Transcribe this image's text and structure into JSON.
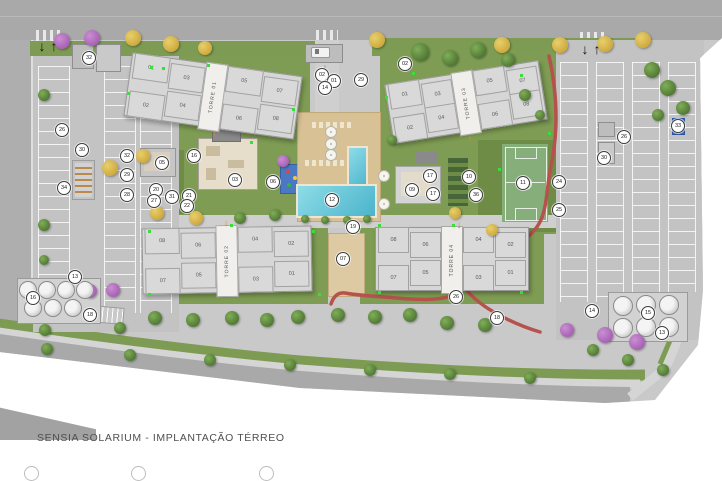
{
  "title": {
    "text": "SENSIA SOLARIUM - IMPLANTAÇÃO TÉRREO"
  },
  "towers": [
    {
      "name": "TORRE 01",
      "x": 127,
      "y": 64,
      "w": 170,
      "h": 62,
      "rot": 8,
      "top": [
        "01",
        "03",
        "05",
        "07"
      ],
      "bottom": [
        "02",
        "04",
        "06",
        "08"
      ]
    },
    {
      "name": "TORRE 03",
      "x": 388,
      "y": 72,
      "w": 154,
      "h": 58,
      "rot": -9,
      "top": [
        "01",
        "03",
        "05",
        "07"
      ],
      "bottom": [
        "02",
        "04",
        "06",
        "08"
      ]
    },
    {
      "name": "TORRE 02",
      "x": 142,
      "y": 227,
      "w": 168,
      "h": 64,
      "rot": -1,
      "top": [
        "08",
        "06",
        "04",
        "02"
      ],
      "bottom": [
        "07",
        "05",
        "03",
        "01"
      ]
    },
    {
      "name": "TORRE 04",
      "x": 375,
      "y": 227,
      "w": 152,
      "h": 62,
      "rot": 0,
      "top": [
        "08",
        "06",
        "04",
        "02"
      ],
      "bottom": [
        "07",
        "05",
        "03",
        "01"
      ]
    }
  ],
  "markers": [
    [
      "02",
      322,
      75
    ],
    [
      "01",
      334,
      81
    ],
    [
      "14",
      325,
      88
    ],
    [
      "29",
      361,
      80
    ],
    [
      "02",
      405,
      64
    ],
    [
      "32",
      89,
      58
    ],
    [
      "26",
      62,
      130
    ],
    [
      "30",
      82,
      150
    ],
    [
      "34",
      64,
      188
    ],
    [
      "13",
      75,
      277
    ],
    [
      "16",
      33,
      298
    ],
    [
      "18",
      90,
      315
    ],
    [
      "32",
      127,
      156
    ],
    [
      "29",
      127,
      175
    ],
    [
      "28",
      127,
      195
    ],
    [
      "05",
      162,
      163
    ],
    [
      "16",
      194,
      156
    ],
    [
      "03",
      235,
      180
    ],
    [
      "06",
      273,
      182
    ],
    [
      "20",
      156,
      190
    ],
    [
      "31",
      172,
      197
    ],
    [
      "21",
      189,
      196
    ],
    [
      "27",
      154,
      201
    ],
    [
      "22",
      187,
      206
    ],
    [
      "12",
      332,
      200
    ],
    [
      "19",
      353,
      227
    ],
    [
      "07",
      343,
      259
    ],
    [
      "09",
      412,
      190
    ],
    [
      "17",
      430,
      176
    ],
    [
      "17",
      433,
      194
    ],
    [
      "10",
      469,
      177
    ],
    [
      "36",
      476,
      195
    ],
    [
      "11",
      523,
      183
    ],
    [
      "24",
      559,
      182
    ],
    [
      "25",
      559,
      210
    ],
    [
      "26",
      624,
      137
    ],
    [
      "30",
      604,
      158
    ],
    [
      "33",
      678,
      126
    ],
    [
      "26",
      456,
      297
    ],
    [
      "18",
      497,
      318
    ],
    [
      "14",
      592,
      311
    ],
    [
      "15",
      648,
      313
    ],
    [
      "13",
      662,
      333
    ]
  ],
  "trees": [
    [
      133,
      38,
      8,
      "y"
    ],
    [
      171,
      44,
      8,
      "y"
    ],
    [
      205,
      48,
      7,
      "y"
    ],
    [
      377,
      40,
      8,
      "y"
    ],
    [
      502,
      45,
      8,
      "y"
    ],
    [
      560,
      45,
      8,
      "y"
    ],
    [
      605,
      44,
      8,
      "y"
    ],
    [
      643,
      40,
      8,
      "y"
    ],
    [
      62,
      41,
      8,
      "p"
    ],
    [
      92,
      38,
      8,
      "p"
    ],
    [
      420,
      52,
      9,
      "g"
    ],
    [
      450,
      58,
      8,
      "g"
    ],
    [
      478,
      50,
      8,
      "g"
    ],
    [
      508,
      60,
      7,
      "g"
    ],
    [
      652,
      70,
      8,
      "g"
    ],
    [
      668,
      88,
      8,
      "g"
    ],
    [
      683,
      108,
      7,
      "g"
    ],
    [
      658,
      115,
      6,
      "g"
    ],
    [
      143,
      156,
      7,
      "y"
    ],
    [
      110,
      168,
      8,
      "y"
    ],
    [
      157,
      213,
      7,
      "y"
    ],
    [
      196,
      218,
      7,
      "y"
    ],
    [
      240,
      218,
      6,
      "g"
    ],
    [
      275,
      215,
      6,
      "g"
    ],
    [
      455,
      213,
      6,
      "y"
    ],
    [
      492,
      230,
      6,
      "y"
    ],
    [
      283,
      161,
      6,
      "p"
    ],
    [
      44,
      95,
      6,
      "g"
    ],
    [
      44,
      225,
      6,
      "g"
    ],
    [
      44,
      260,
      5,
      "g"
    ],
    [
      90,
      291,
      7,
      "p"
    ],
    [
      113,
      290,
      7,
      "p"
    ],
    [
      567,
      330,
      7,
      "p"
    ],
    [
      605,
      335,
      8,
      "p"
    ],
    [
      637,
      342,
      8,
      "p"
    ],
    [
      45,
      330,
      6,
      "g"
    ],
    [
      120,
      328,
      6,
      "g"
    ],
    [
      155,
      318,
      7,
      "g"
    ],
    [
      193,
      320,
      7,
      "g"
    ],
    [
      232,
      318,
      7,
      "g"
    ],
    [
      267,
      320,
      7,
      "g"
    ],
    [
      298,
      317,
      7,
      "g"
    ],
    [
      338,
      315,
      7,
      "g"
    ],
    [
      375,
      317,
      7,
      "g"
    ],
    [
      410,
      315,
      7,
      "g"
    ],
    [
      447,
      323,
      7,
      "g"
    ],
    [
      485,
      325,
      7,
      "g"
    ],
    [
      47,
      349,
      6,
      "g"
    ],
    [
      130,
      355,
      6,
      "g"
    ],
    [
      210,
      360,
      6,
      "g"
    ],
    [
      290,
      365,
      6,
      "g"
    ],
    [
      370,
      370,
      6,
      "g"
    ],
    [
      450,
      374,
      6,
      "g"
    ],
    [
      530,
      378,
      6,
      "g"
    ],
    [
      593,
      350,
      6,
      "g"
    ],
    [
      628,
      360,
      6,
      "g"
    ],
    [
      663,
      370,
      6,
      "g"
    ],
    [
      525,
      95,
      6,
      "g"
    ],
    [
      540,
      115,
      5,
      "g"
    ],
    [
      392,
      140,
      5,
      "g"
    ],
    [
      305,
      219,
      4,
      "g"
    ],
    [
      325,
      220,
      4,
      "g"
    ],
    [
      347,
      220,
      4,
      "g"
    ],
    [
      367,
      219,
      4,
      "g"
    ]
  ],
  "green_dots": [
    [
      127,
      92
    ],
    [
      150,
      66
    ],
    [
      207,
      64
    ],
    [
      292,
      108
    ],
    [
      250,
      141
    ],
    [
      162,
      67
    ],
    [
      385,
      96
    ],
    [
      412,
      72
    ],
    [
      520,
      74
    ],
    [
      548,
      132
    ],
    [
      498,
      168
    ],
    [
      148,
      230
    ],
    [
      148,
      293
    ],
    [
      230,
      224
    ],
    [
      312,
      230
    ],
    [
      318,
      293
    ],
    [
      378,
      224
    ],
    [
      378,
      291
    ],
    [
      452,
      224
    ],
    [
      520,
      291
    ]
  ],
  "umbrellas": [
    [
      330,
      131
    ],
    [
      330,
      143
    ],
    [
      330,
      154
    ],
    [
      383,
      175
    ],
    [
      383,
      203
    ]
  ],
  "tanks_left": [
    [
      27,
      289
    ],
    [
      46,
      289
    ],
    [
      65,
      289
    ],
    [
      84,
      289
    ],
    [
      32,
      307
    ],
    [
      52,
      307
    ],
    [
      72,
      307
    ]
  ],
  "tanks_right": [
    [
      622,
      305
    ],
    [
      645,
      304
    ],
    [
      668,
      304
    ],
    [
      622,
      327
    ],
    [
      645,
      326
    ],
    [
      668,
      326
    ]
  ],
  "arrows": [
    {
      "x": 42,
      "y": 46,
      "g": "↓",
      "c": "#111111",
      "s": 14
    },
    {
      "x": 54,
      "y": 46,
      "g": "↑",
      "c": "#111111",
      "s": 14
    },
    {
      "x": 585,
      "y": 49,
      "g": "↓",
      "c": "#111111",
      "s": 14
    },
    {
      "x": 597,
      "y": 49,
      "g": "↑",
      "c": "#111111",
      "s": 14
    },
    {
      "x": 325,
      "y": 68,
      "g": "↓",
      "c": "#2f7fd6",
      "s": 13
    },
    {
      "x": 214,
      "y": 134,
      "g": "↑",
      "c": "#e8862e",
      "s": 10
    },
    {
      "x": 470,
      "y": 140,
      "g": "↑",
      "c": "#e8862e",
      "s": 10
    },
    {
      "x": 226,
      "y": 224,
      "g": "↓",
      "c": "#e8862e",
      "s": 10
    },
    {
      "x": 459,
      "y": 226,
      "g": "↓",
      "c": "#e8862e",
      "s": 10
    }
  ],
  "legend_stub_x": [
    24,
    131,
    259
  ],
  "colors": {
    "lawn": "#7e9c53",
    "water": "#4cb4cb",
    "track": "#b5524c",
    "sand": "#decaa2",
    "court": "#86ae7b",
    "deck": "#d8c195",
    "road": "#a9a9a9",
    "marker_border": "#3a3a3a"
  }
}
